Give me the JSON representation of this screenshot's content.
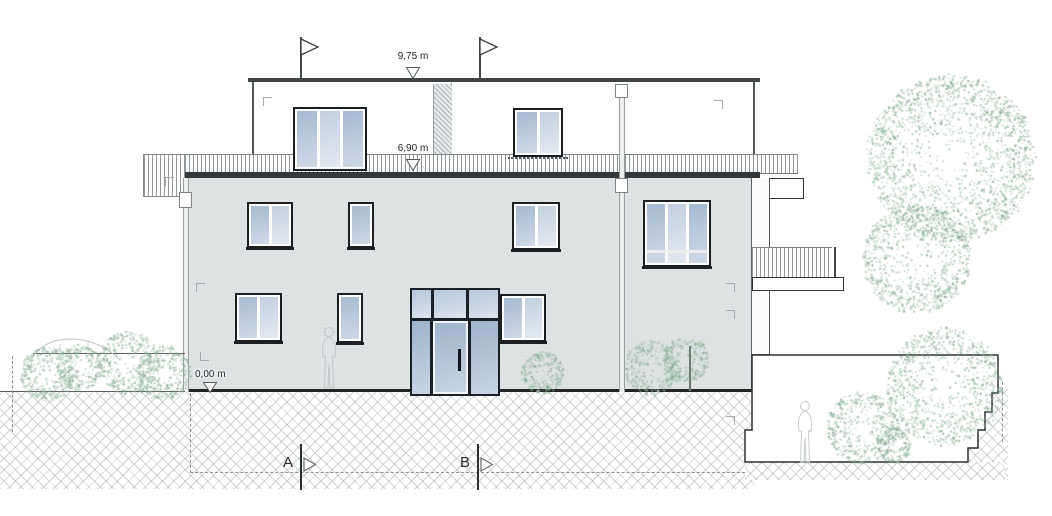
{
  "annotations": {
    "dim_roof": "9,75 m",
    "dim_balcony": "6,90 m",
    "dim_ground": "0,00 m",
    "section_a": "A",
    "section_b": "B"
  },
  "colors": {
    "facade": "#dfe3e4",
    "glass_dark": "#a7bad1",
    "glass_light": "#e3e9f1",
    "frame": "#1b1f22",
    "line": "#2b2f31",
    "tree_greens": [
      "#7fa98b",
      "#92b89c",
      "#a6c7af"
    ],
    "tree_gray": "#9aa0a1"
  }
}
